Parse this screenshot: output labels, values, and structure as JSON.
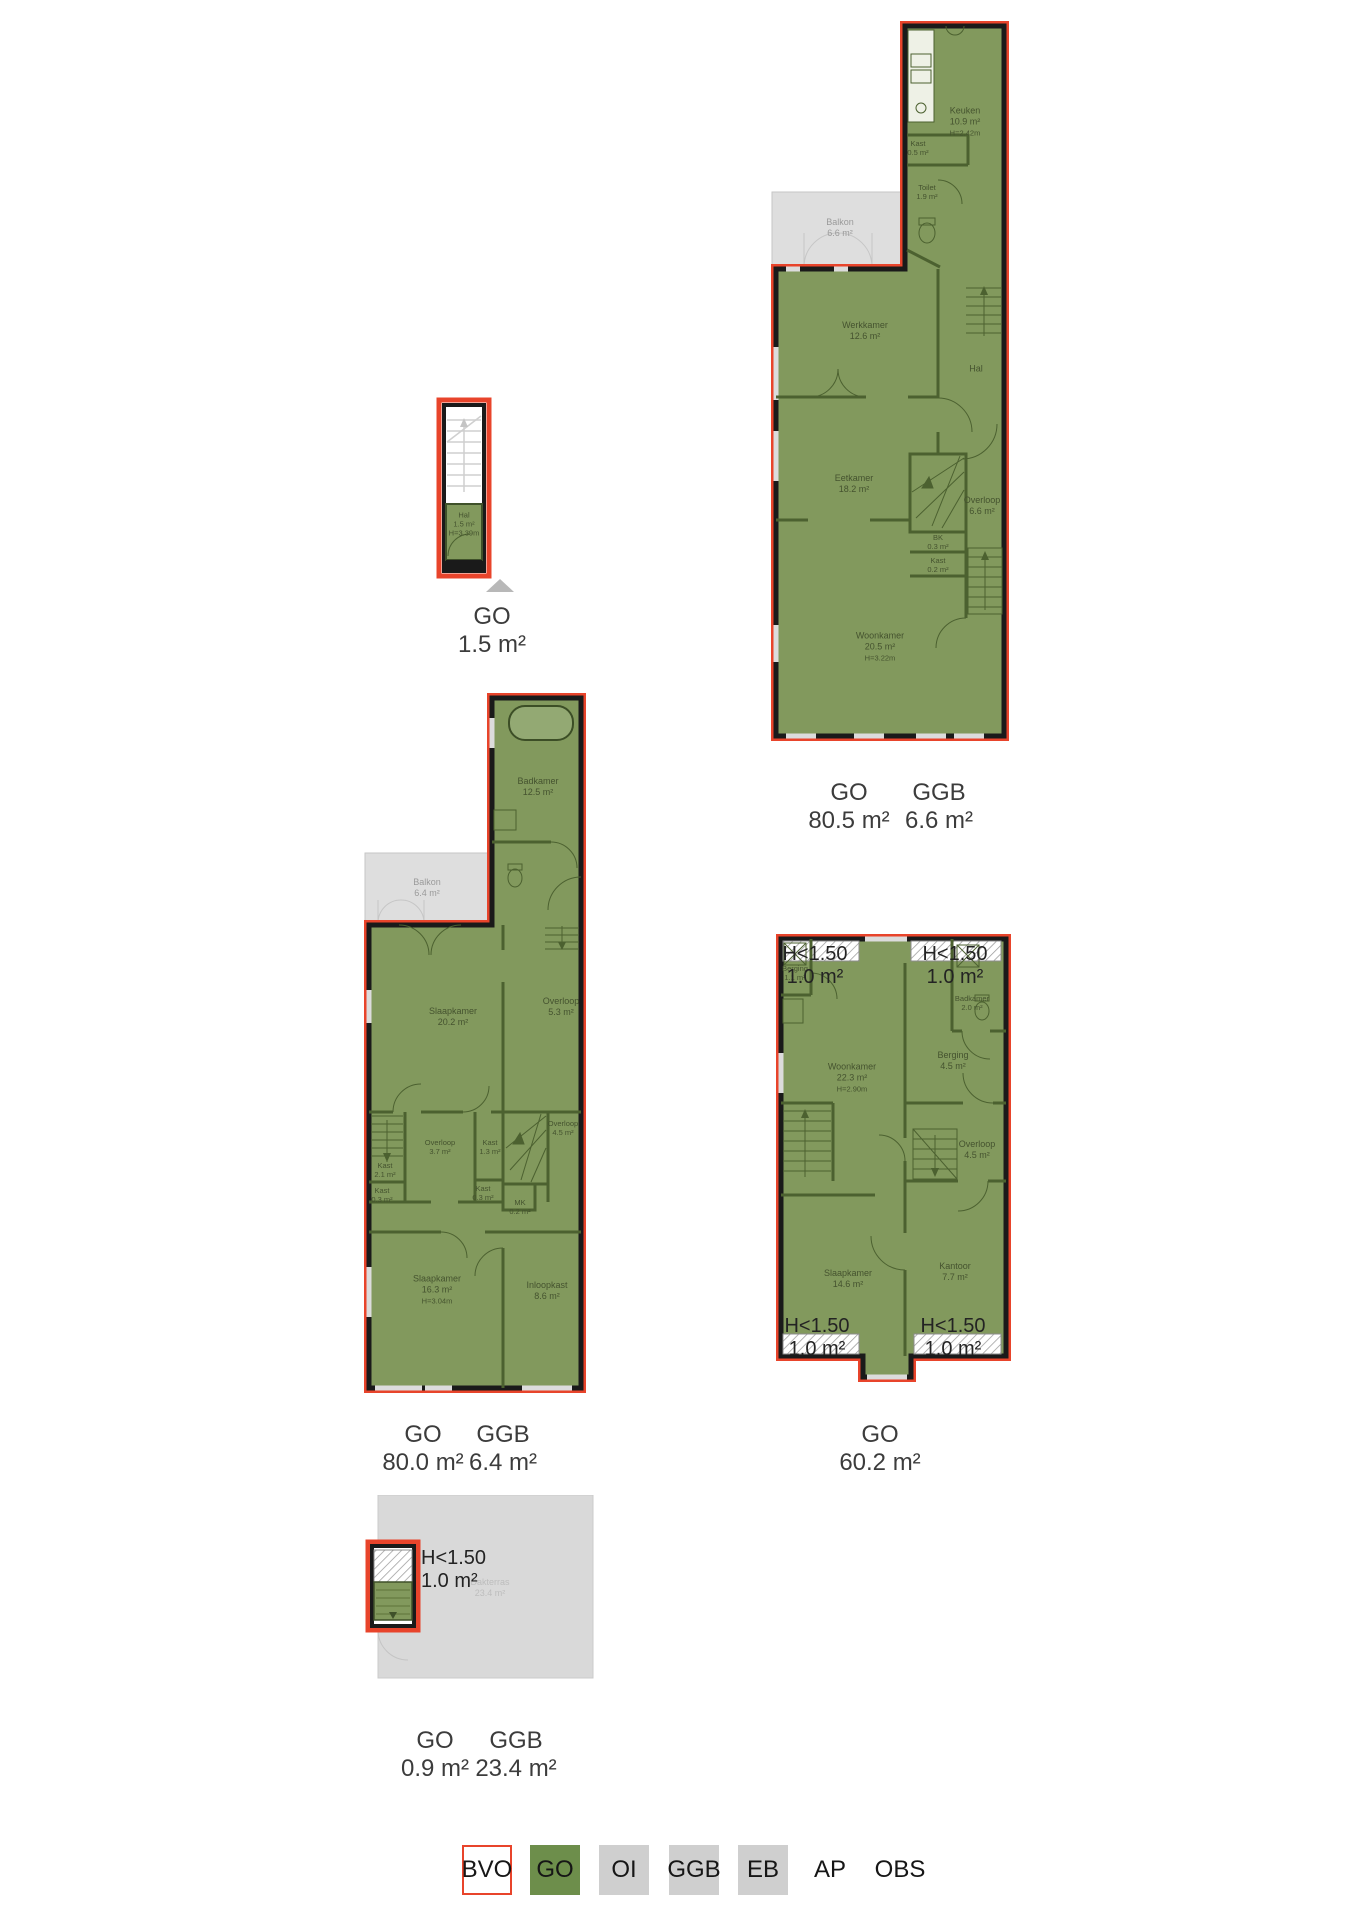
{
  "colors": {
    "outline_red": "#e8442b",
    "room_green": "#82995d",
    "legend_green": "#6d8e4b",
    "wall_black": "#1a1a1a",
    "wall_green": "#4c6130",
    "area_gray": "#dcdcdc"
  },
  "h150": {
    "line1": "H<1.50",
    "line2": "1.0 m²"
  },
  "plans": {
    "hal_entrance": {
      "area_labels": [
        {
          "term": "GO",
          "value": "1.5 m²"
        }
      ],
      "rooms": {
        "hal": {
          "name": "Hal",
          "area": "1.5 m²",
          "height": "H=3.39m"
        }
      }
    },
    "first_floor": {
      "area_labels": [
        {
          "term": "GO",
          "value": "80.5 m²"
        },
        {
          "term": "GGB",
          "value": "6.6 m²"
        }
      ],
      "rooms": {
        "keuken": {
          "name": "Keuken",
          "area": "10.9 m²",
          "height": "H=2.42m"
        },
        "kast_boven": {
          "name": "Kast",
          "area": "0.5 m²"
        },
        "toilet": {
          "name": "Toilet",
          "area": "1.9 m²"
        },
        "balkon": {
          "name": "Balkon",
          "area": "6.6 m²"
        },
        "werkkamer": {
          "name": "Werkkamer",
          "area": "12.6 m²"
        },
        "hal": {
          "name": "Hal"
        },
        "eetkamer": {
          "name": "Eetkamer",
          "area": "18.2 m²"
        },
        "overloop": {
          "name": "Overloop",
          "area": "6.6 m²"
        },
        "bk": {
          "name": "BK",
          "area": "0.3 m²"
        },
        "kast_midden": {
          "name": "Kast",
          "area": "0.2 m²"
        },
        "woonkamer": {
          "name": "Woonkamer",
          "area": "20.5 m²",
          "height": "H=3.22m"
        }
      }
    },
    "second_floor": {
      "area_labels": [
        {
          "term": "GO",
          "value": "80.0 m²"
        },
        {
          "term": "GGB",
          "value": "6.4 m²"
        }
      ],
      "rooms": {
        "badkamer": {
          "name": "Badkamer",
          "area": "12.5 m²"
        },
        "balkon": {
          "name": "Balkon",
          "area": "6.4 m²"
        },
        "slaapkamer_voor": {
          "name": "Slaapkamer",
          "area": "20.2 m²"
        },
        "overloop_boven": {
          "name": "Overloop",
          "area": "5.3 m²"
        },
        "overloop_midden": {
          "name": "Overloop",
          "area": "3.7 m²"
        },
        "kast_13": {
          "name": "Kast",
          "area": "1.3 m²"
        },
        "overloop_onder": {
          "name": "Overloop",
          "area": "4.5 m²"
        },
        "kast_21": {
          "name": "Kast",
          "area": "2.1 m²"
        },
        "kast_03a": {
          "name": "Kast",
          "area": "0.3 m²"
        },
        "kast_03b": {
          "name": "Kast",
          "area": "0.3 m²"
        },
        "mk": {
          "name": "MK",
          "area": "0.2 m²"
        },
        "slaapkamer_achter": {
          "name": "Slaapkamer",
          "area": "16.3 m²",
          "height": "H=3.04m"
        },
        "inloopkast": {
          "name": "Inloopkast",
          "area": "8.6 m²"
        }
      }
    },
    "third_floor": {
      "area_labels": [
        {
          "term": "GO",
          "value": "60.2 m²"
        }
      ],
      "rooms": {
        "berging_klein": {
          "name": "Berging",
          "area": "1.1 m²"
        },
        "badkamer": {
          "name": "Badkamer",
          "area": "2.0 m²"
        },
        "woonkamer": {
          "name": "Woonkamer",
          "area": "22.3 m²",
          "height": "H=2.90m"
        },
        "berging": {
          "name": "Berging",
          "area": "4.5 m²"
        },
        "overloop": {
          "name": "Overloop",
          "area": "4.5 m²"
        },
        "slaapkamer": {
          "name": "Slaapkamer",
          "area": "14.6 m²"
        },
        "kantoor": {
          "name": "Kantoor",
          "area": "7.7 m²"
        }
      }
    },
    "roof": {
      "area_labels": [
        {
          "term": "GO",
          "value": "0.9 m²"
        },
        {
          "term": "GGB",
          "value": "23.4 m²"
        }
      ],
      "rooms": {
        "dakterras": {
          "name": "Dakterras",
          "area": "23.4 m²"
        }
      }
    }
  },
  "legend": {
    "items": [
      {
        "label": "BVO"
      },
      {
        "label": "GO"
      },
      {
        "label": "OI"
      },
      {
        "label": "GGB"
      },
      {
        "label": "EB"
      },
      {
        "label": "AP"
      },
      {
        "label": "OBS"
      }
    ]
  }
}
